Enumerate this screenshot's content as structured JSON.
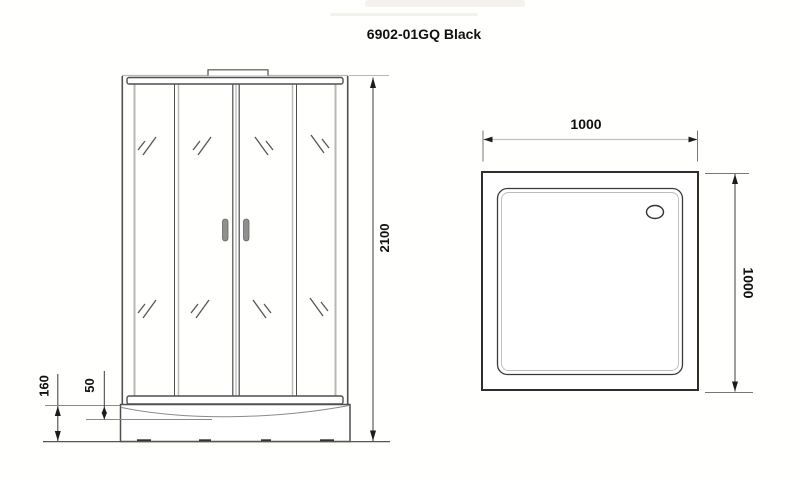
{
  "window": {
    "width": "800",
    "height": "477"
  },
  "title": "6902-01GQ Black",
  "front_view": {
    "name": "shower-cabin-front-elevation",
    "dim_height": "2100",
    "dim_tray_height": "160",
    "dim_tray_lip": "50"
  },
  "top_view": {
    "name": "shower-tray-plan",
    "dim_width": "1000",
    "dim_depth": "1000",
    "drain": "drain-hole"
  },
  "colors": {
    "background": "#ffffff",
    "line_dark": "#4f4f4f",
    "line_gray": "#b7b7b7",
    "line_black": "#2e2e2e",
    "dim_line": "#3c3c3c",
    "dim_line_light": "#c0c0c0",
    "arrow": "#1c1c1c",
    "text": "#111111",
    "handle_fill": "#8f8f8f",
    "feet": "#333333"
  }
}
